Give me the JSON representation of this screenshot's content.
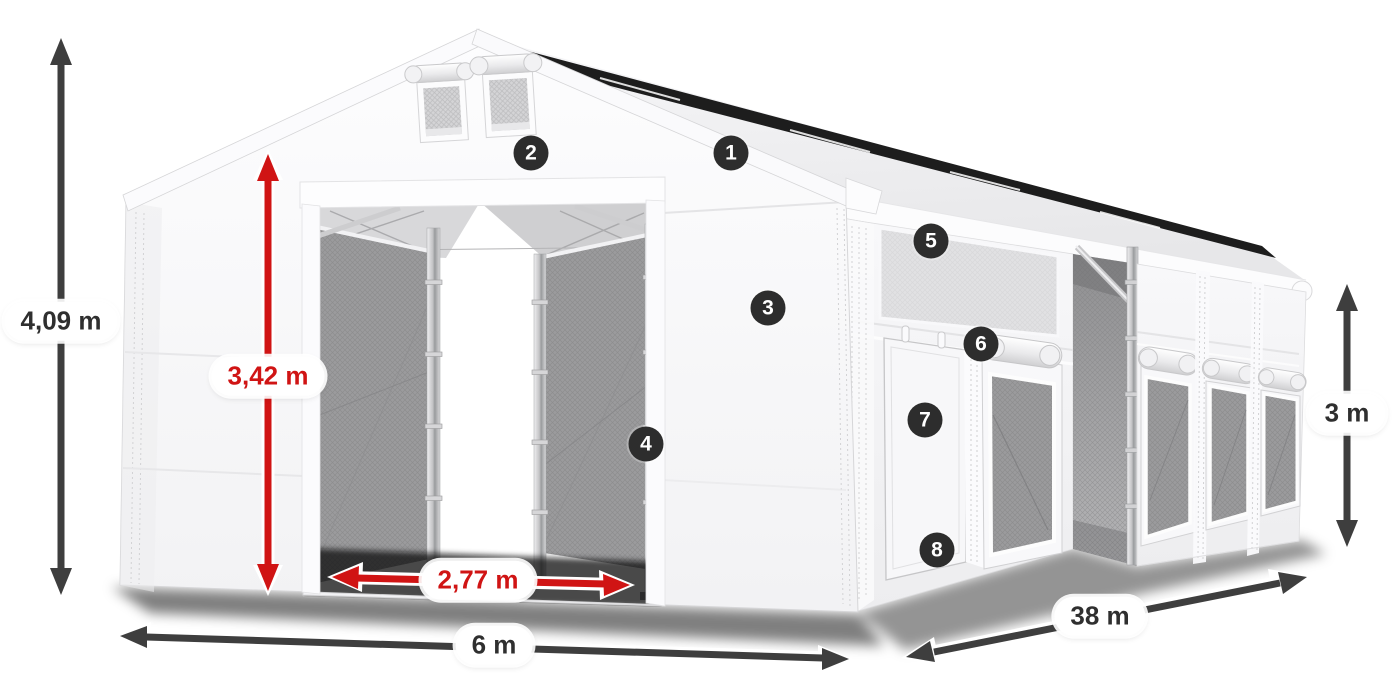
{
  "product_diagram": {
    "dimensions": {
      "total_height": "4,09 m",
      "entrance_height": "3,42 m",
      "entrance_width": "2,77 m",
      "front_width": "6 m",
      "length": "38 m",
      "side_wall_height": "3 m"
    },
    "part_markers": [
      "1",
      "2",
      "3",
      "4",
      "5",
      "6",
      "7",
      "8"
    ],
    "colors": {
      "dimension_red": "#d01414",
      "dimension_dark": "#3e3e3e",
      "marker_background": "#2d2d2d",
      "page_background": "#ffffff"
    }
  }
}
